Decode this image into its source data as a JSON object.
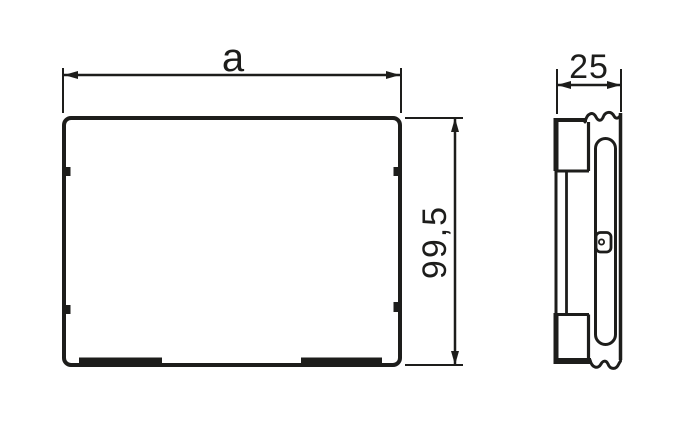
{
  "drawing": {
    "front_view": {
      "width_label": "a",
      "height_label": "99,5"
    },
    "side_view": {
      "depth_label": "25"
    },
    "colors": {
      "line": "#1d1d1b",
      "background": "#ffffff"
    }
  }
}
